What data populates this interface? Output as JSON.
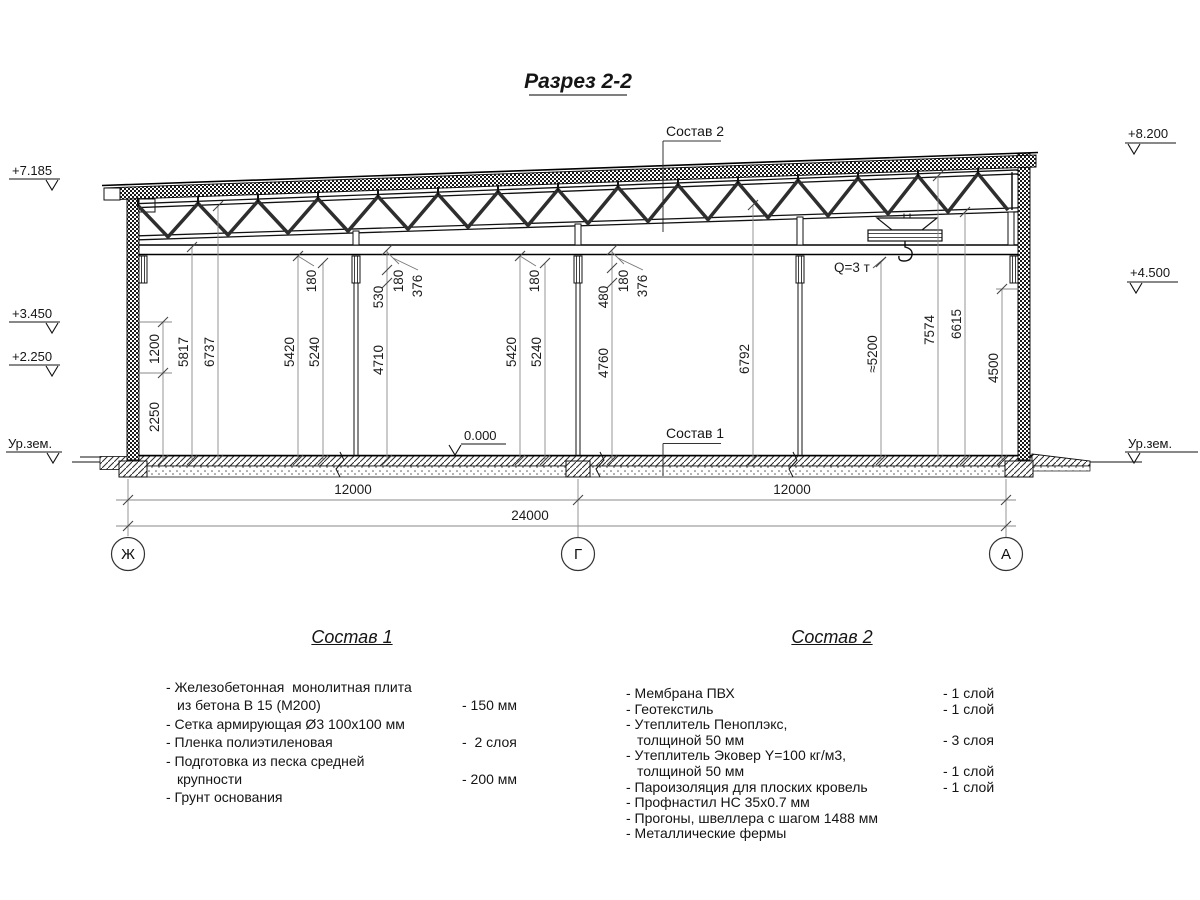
{
  "title": "Разрез 2-2",
  "labels": {
    "sostav1_callout": "Состав 1",
    "sostav2_callout": "Состав 2",
    "crane": "Q=3 т"
  },
  "elevations": {
    "el_7185": "+7.185",
    "el_3450": "+3.450",
    "el_2250": "+2.250",
    "el_ground_left": "Ур.зем.",
    "el_8200": "+8.200",
    "el_4500": "+4.500",
    "el_ground_right": "Ур.зем.",
    "el_zero": "0.000"
  },
  "axes": {
    "zh": "Ж",
    "g": "Г",
    "a": "А"
  },
  "dims": {
    "d1200": "1200",
    "d2250": "2250",
    "d5817": "5817",
    "d6737": "6737",
    "dl5420": "5420",
    "dl5240": "5240",
    "dl180": "180",
    "d530": "530",
    "dl180b": "180",
    "dl376": "376",
    "d4710": "4710",
    "dm5420": "5420",
    "dm5240": "5240",
    "dm180": "180",
    "d480": "480",
    "dm180b": "180",
    "dm376": "376",
    "d4760": "4760",
    "d6792": "6792",
    "d5200": "≈5200",
    "d7574": "7574",
    "d6615": "6615",
    "d4500": "4500",
    "span_left": "12000",
    "span_right": "12000",
    "total": "24000"
  },
  "spec1": {
    "title": "Состав 1",
    "items": [
      {
        "t": "- Железобетонная  монолитная плита",
        "v": ""
      },
      {
        "t": "из бетона В 15 (М200)",
        "v": "- 150 мм"
      },
      {
        "t": "- Сетка армирующая Ø3 100х100 мм",
        "v": ""
      },
      {
        "t": "- Пленка полиэтиленовая",
        "v": "-  2 слоя"
      },
      {
        "t": "- Подготовка из песка средней",
        "v": ""
      },
      {
        "t": "крупности",
        "v": "- 200 мм"
      },
      {
        "t": "- Грунт основания",
        "v": ""
      }
    ]
  },
  "spec2": {
    "title": "Состав 2",
    "items": [
      {
        "t": "- Мембрана ПВХ",
        "v": "- 1 слой"
      },
      {
        "t": "- Геотекстиль",
        "v": "- 1 слой"
      },
      {
        "t": "- Утеплитель Пеноплэкс,",
        "v": ""
      },
      {
        "t": "толщиной 50 мм",
        "v": "- 3 слоя"
      },
      {
        "t": "- Утеплитель Эковер Y=100 кг/м3,",
        "v": ""
      },
      {
        "t": "толщиной 50 мм",
        "v": "- 1 слой"
      },
      {
        "t": "- Пароизоляция для плоских кровель",
        "v": "- 1 слой"
      },
      {
        "t": "- Профнастил НС 35х0.7 мм",
        "v": ""
      },
      {
        "t": "- Прогоны, швеллера с шагом 1488 мм",
        "v": ""
      },
      {
        "t": "- Металлические фермы",
        "v": ""
      }
    ]
  }
}
